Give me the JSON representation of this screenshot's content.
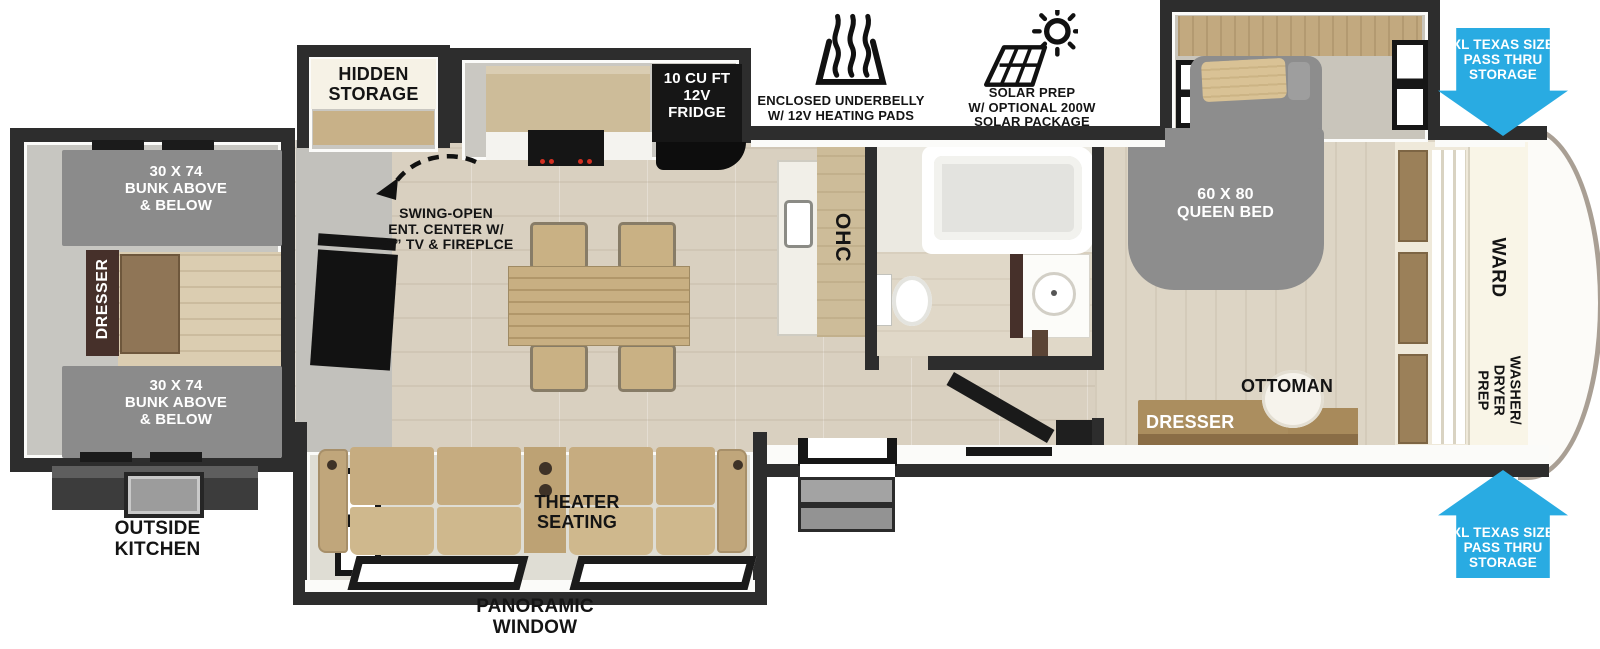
{
  "colors": {
    "arrow_blue": "#29abe2",
    "wall": "#2d2d2d",
    "bed_gray": "#8c8c8c",
    "sofa_tan": "#c6ac80",
    "counter_wood": "#cdbc99",
    "floor_wood": "#d9d0c0"
  },
  "bunk_room": {
    "bunk_top_label": "30 X 74\nBUNK ABOVE\n& BELOW",
    "bunk_bottom_label": "30 X 74\nBUNK ABOVE\n& BELOW",
    "dresser_label": "DRESSER"
  },
  "living_area": {
    "hidden_storage_label": "HIDDEN\nSTORAGE",
    "swing_open_label": "SWING-OPEN\nENT. CENTER W/\n50” TV & FIREPLCE",
    "fridge_label": "10 CU FT\n12V\nFRIDGE",
    "ohc_label": "OHC",
    "theater_seating_label": "THEATER\nSEATING"
  },
  "bedroom": {
    "queen_bed_label": "60 X 80\nQUEEN BED",
    "ottoman_label": "OTTOMAN",
    "dresser_label": "DRESSER",
    "ward_label": "WARD",
    "washer_dryer_label": "WASHER/\nDRYER\nPREP"
  },
  "exterior": {
    "outside_kitchen_label": "OUTSIDE\nKITCHEN",
    "panoramic_window_label": "PANORAMIC\nWINDOW",
    "underbelly_label": "ENCLOSED UNDERBELLY\nW/ 12V HEATING PADS",
    "solar_label": "SOLAR PREP\nW/ OPTIONAL 200W\nSOLAR PACKAGE",
    "pass_thru_top_label": "XL TEXAS SIZE\nPASS THRU\nSTORAGE",
    "pass_thru_bottom_label": "XL TEXAS SIZE\nPASS THRU\nSTORAGE"
  }
}
